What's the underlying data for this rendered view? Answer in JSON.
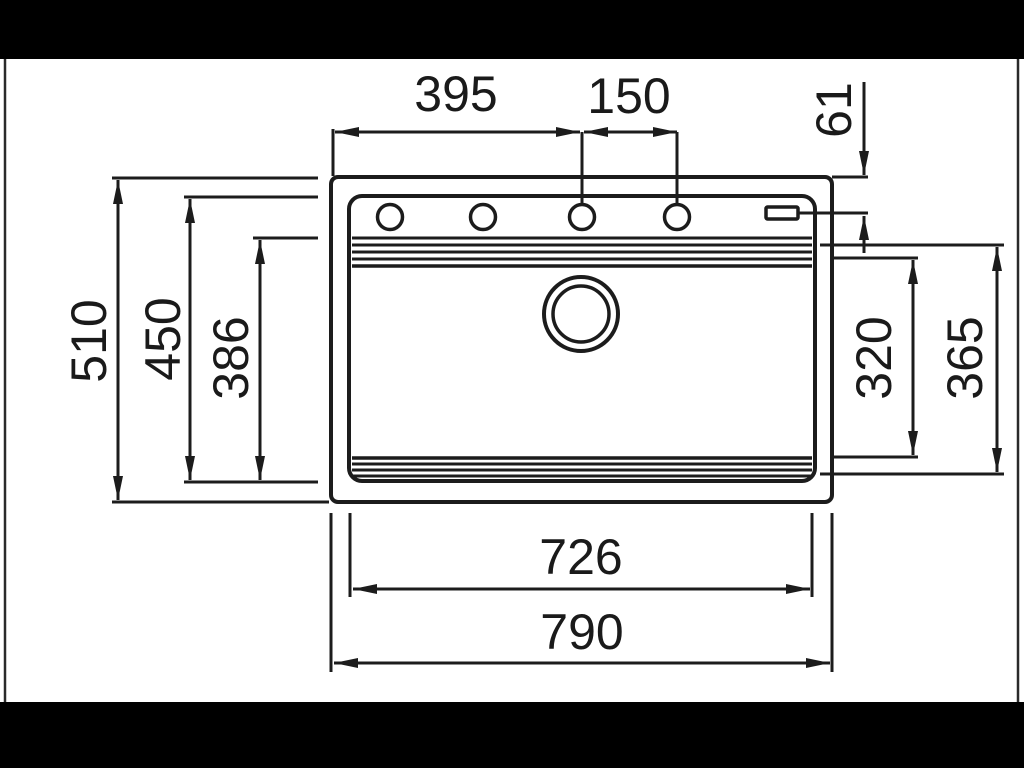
{
  "diagram": {
    "dimensions": {
      "width_to_third_hole": "395",
      "faucet_hole_spacing": "150",
      "top_edge_to_holes": "61",
      "outer_depth": "510",
      "rim_depth": "450",
      "bowl_depth": "386",
      "bowl_inner_height": "320",
      "bowl_outer_height": "365",
      "rim_width": "726",
      "outer_width": "790"
    },
    "colors": {
      "line": "#1c1c1c",
      "paper": "#ffffff",
      "letterbox": "#000000"
    }
  }
}
